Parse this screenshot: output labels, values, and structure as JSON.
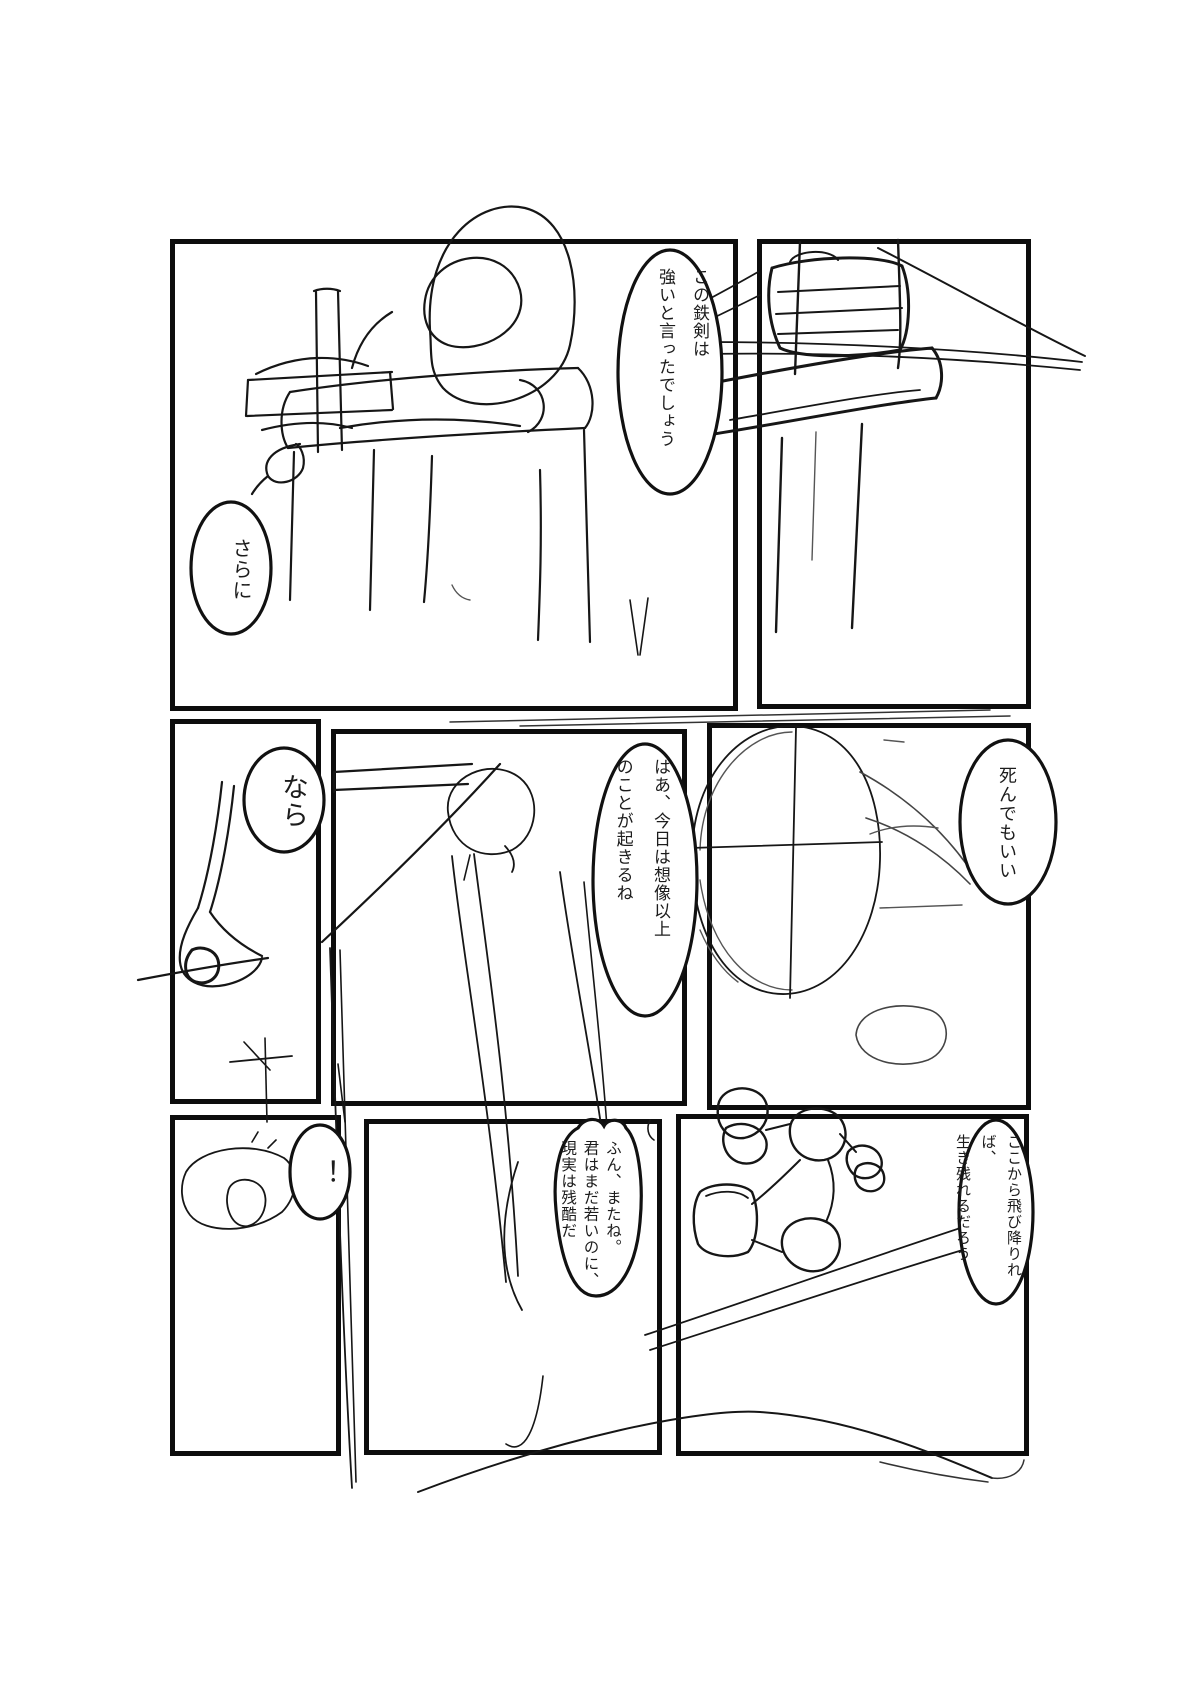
{
  "page": {
    "type": "manga-sketch-page",
    "background_color": "#ffffff",
    "ink_color": "#111111",
    "panel_count": 8
  },
  "bubbles": {
    "b1": {
      "panel": "top-left",
      "text": "この鉄剣は\n強いと言ったでしょう"
    },
    "b2": {
      "panel": "top-left",
      "text": "さらに"
    },
    "b3": {
      "panel": "middle-left",
      "text": "なら"
    },
    "b4": {
      "panel": "middle-center",
      "text": "はあ、今日は想像以上\nのことが起きるね"
    },
    "b5": {
      "panel": "middle-right",
      "text": "死んでもいい"
    },
    "b6": {
      "panel": "bottom-left",
      "text": "！"
    },
    "b7": {
      "panel": "bottom-center",
      "text": "ふん、またね。\n君はまだ若いのに、\n現実は残酷だ"
    },
    "b8": {
      "panel": "bottom-right",
      "text": "ここから飛び降りれば、\n生き残れるだろう"
    }
  }
}
